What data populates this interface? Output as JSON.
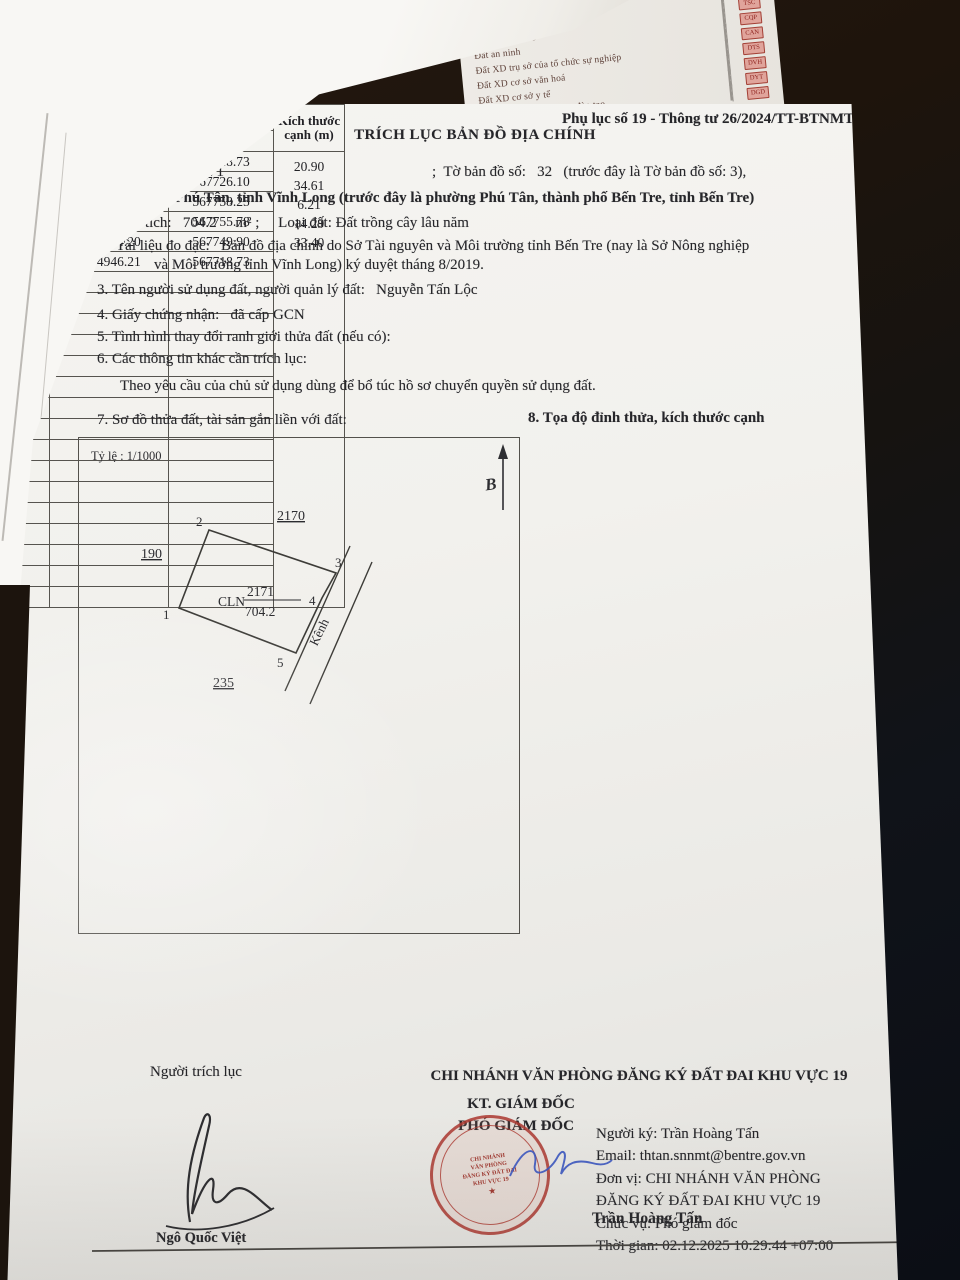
{
  "doc": {
    "form_ref": "Phụ lục số 19 - Thông tư 26/2024/TT-BTNMT",
    "title": "TRÍCH LỤC BẢN ĐỒ ĐỊA CHÍNH",
    "line1_left": "1. Thửa đất số:  2171",
    "line1_right": ";  Tờ bản đồ số:   32   (trước đây là Tờ bản đồ số: 3),",
    "line1_address": "Phường Phú Tân, tỉnh Vĩnh Long (trước đây là phường Phú Tân, thành phố Bến Tre, tỉnh Bến Tre)",
    "line2": "2. Diện tích:   704.2     m² ;     Loại đất: Đất trồng cây lâu năm",
    "line2_doc1": "Tài liệu đo đạc:   Bản đồ địa chính do Sở Tài nguyên và Môi trường tỉnh Bến Tre (nay là Sở Nông nghiệp",
    "line2_doc2": "và Môi trường tỉnh Vĩnh Long) ký duyệt tháng 8/2019.",
    "line3": "3. Tên người sử dụng đất, người quản lý đất:   Nguyễn Tấn Lộc",
    "line4": "4. Giấy chứng nhận:   đã cấp GCN",
    "line5": "5. Tình hình thay đổi ranh giới thửa đất (nếu có):",
    "line6": "6. Các thông tin khác cần trích lục:",
    "line6_note": "Theo yêu cầu của chủ sử dụng dùng để bổ túc hồ sơ chuyển quyền sử dụng đất.",
    "section7": "7. Sơ đồ thửa đất, tài sản gắn liền với đất:",
    "section8": "8. Tọa độ đỉnh thửa, kích thước cạnh"
  },
  "map": {
    "scale": "Tỷ lệ : 1/1000",
    "north_letter": "B",
    "parcel_type": "CLN",
    "parcel_number": "2171",
    "parcel_area": "704.2",
    "neighbor_top": "2170",
    "neighbor_left": "190",
    "neighbor_bottom": "235",
    "canal_label": "Kênh",
    "v1": "1",
    "v2": "2",
    "v3": "3",
    "v4": "4",
    "v5": "5"
  },
  "table": {
    "group_header": "Tọa độ đỉnh thửa",
    "col_vertex": "Đỉnh",
    "col_x": "X (m)",
    "col_y": "Y (m)",
    "col_edge": "Kích thước cạnh (m)",
    "rows": [
      {
        "v": "1",
        "x": "1134946.21",
        "y": "567718.73"
      },
      {
        "v": "2",
        "x": "1134965.76",
        "y": "567726.10"
      },
      {
        "v": "3",
        "x": "1134952.93",
        "y": "567758.25"
      },
      {
        "v": "4",
        "x": "1134947.23",
        "y": "567755.78"
      },
      {
        "v": "5",
        "x": "1134934.20",
        "y": "567749.90"
      },
      {
        "v": "1",
        "x": "1134946.21",
        "y": "567718.73"
      }
    ],
    "edges": [
      "20.90",
      "34.61",
      "6.21",
      "14.29",
      "33.40"
    ]
  },
  "footer": {
    "extractor_label": "Người trích lục",
    "office": "CHI NHÁNH VĂN PHÒNG ĐĂNG KÝ ĐẤT ĐAI KHU VỰC 19",
    "on_behalf": "KT. GIÁM ĐỐC",
    "deputy_title": "PHÓ GIÁM ĐỐC",
    "signer_left": "Ngô Quốc Việt",
    "signer_right": "Trần Hoàng Tấn",
    "digital_lines": "Người ký: Trần Hoàng Tấn\nEmail: thtan.snnmt@bentre.gov.vn\nĐơn vị: CHI NHÁNH VĂN PHÒNG\nĐĂNG KÝ ĐẤT ĐAI KHU VỰC 19\nChức vụ: Phó giám đốc\nThời gian: 02.12.2025 10:29:44 +07:00"
  },
  "stamp": {
    "l1": "CHI NHÁNH",
    "l2": "VĂN PHÒNG",
    "l3": "ĐĂNG KÝ ĐẤT ĐAI",
    "l4": "KHU VỰC 19",
    "star": "★"
  },
  "underpaper": {
    "corner_fragment": "đường vào",
    "items": [
      {
        "label": "Đất ở tại đô thị",
        "code": "ODT"
      },
      {
        "label": "Đất xây dựng trụ sở cơ quan",
        "code": "TSC"
      },
      {
        "label": "Đất quốc phòng",
        "code": "CQP"
      },
      {
        "label": "Đất an ninh",
        "code": "CAN"
      },
      {
        "label": "Đất XD trụ sở của tổ chức sự nghiệp",
        "code": "DTS"
      },
      {
        "label": "Đất XD cơ sở văn hoá",
        "code": "DVH"
      },
      {
        "label": "Đất XD cơ sở y tế",
        "code": "DYT"
      },
      {
        "label": "Đất XD cơ sở giáo dục, đào tạo",
        "code": "DGD"
      }
    ]
  }
}
